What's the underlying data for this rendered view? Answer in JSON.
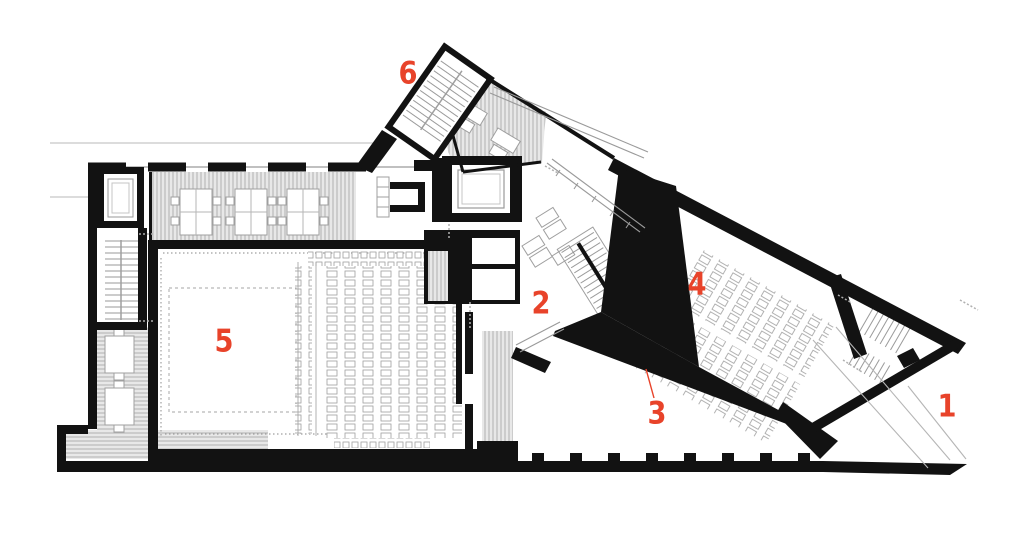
{
  "figure": {
    "kind": "architectural floor plan",
    "background": "#ffffff"
  },
  "colors": {
    "wall": "#121212",
    "hatch_line": "#ababab",
    "hatch_bg": "#e8e8e8",
    "furniture_line": "#9f9f9f",
    "site_line": "#c6c6c6",
    "stage_dash": "#b8b8b8",
    "accent": "#e8432a"
  },
  "markers": [
    {
      "text": "1",
      "x": 947,
      "y": 407
    },
    {
      "text": "2",
      "x": 541,
      "y": 304
    },
    {
      "text": "3",
      "x": 657,
      "y": 414,
      "has_leader": true
    },
    {
      "text": "4",
      "x": 697,
      "y": 285
    },
    {
      "text": "5",
      "x": 224,
      "y": 342
    },
    {
      "text": "6",
      "x": 408,
      "y": 74
    }
  ]
}
